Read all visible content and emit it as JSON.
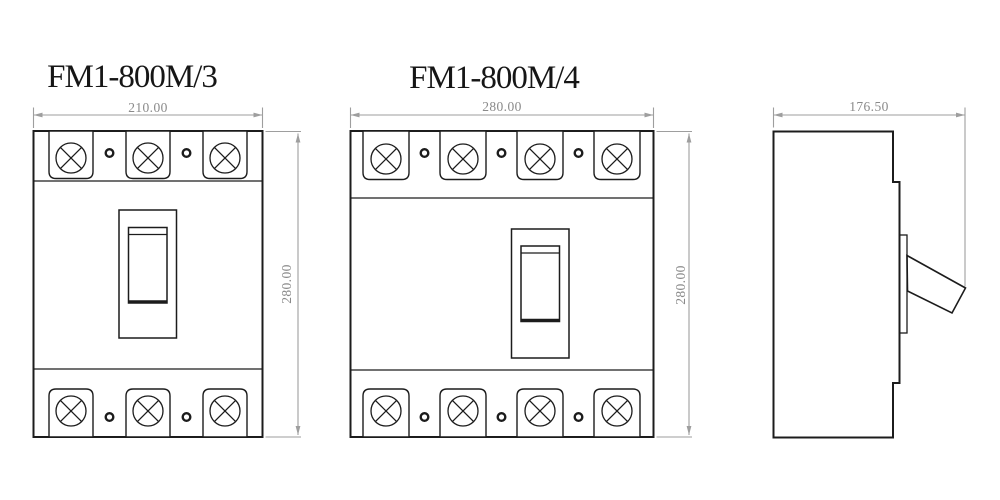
{
  "colors": {
    "background": "#ffffff",
    "outline": "#1c1c1c",
    "dimension_line": "#9e9e9e",
    "dimension_text": "#8a8a8a",
    "title_text": "#161616"
  },
  "views": {
    "front_3pole": {
      "title": "FM1-800M/3",
      "width_dim": "210.00",
      "height_dim": "280.00",
      "pole_count": 3,
      "terminal_screws_top": 3,
      "terminal_screws_bottom": 3,
      "mounting_holes_top": 2,
      "mounting_holes_bottom": 2
    },
    "front_4pole": {
      "title": "FM1-800M/4",
      "width_dim": "280.00",
      "height_dim": "280.00",
      "pole_count": 4,
      "terminal_screws_top": 4,
      "terminal_screws_bottom": 4,
      "mounting_holes_top": 3,
      "mounting_holes_bottom": 3
    },
    "side": {
      "depth_dim": "176.50"
    }
  }
}
